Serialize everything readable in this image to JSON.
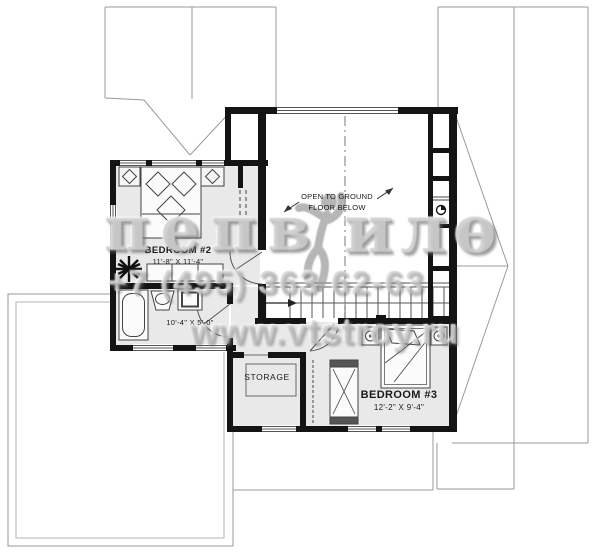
{
  "plan": {
    "rooms": {
      "bedroom2": {
        "name": "BEDROOM #2",
        "dims": "11'-8\" X 11'-4\""
      },
      "bedroom3": {
        "name": "BEDROOM #3",
        "dims": "12'-2\" X 9'-4\""
      },
      "bathroom": {
        "dims": "10'-4\" X 5'-0\""
      },
      "storage": {
        "name": "STORAGE"
      },
      "open_area": {
        "line1": "OPEN TO GROUND",
        "line2": "FLOOR BELOW"
      }
    }
  },
  "watermark": {
    "letters_left": "пепв",
    "letters_right": "илѳ",
    "phone": "+7 (495) 363 62-63",
    "website": "www.vtstroy.ru"
  },
  "colors": {
    "wall": "#141414",
    "room_fill": "#e9e9e9",
    "roof_line": "#9a9a9a",
    "watermark_gray": "#bdbdbd"
  }
}
